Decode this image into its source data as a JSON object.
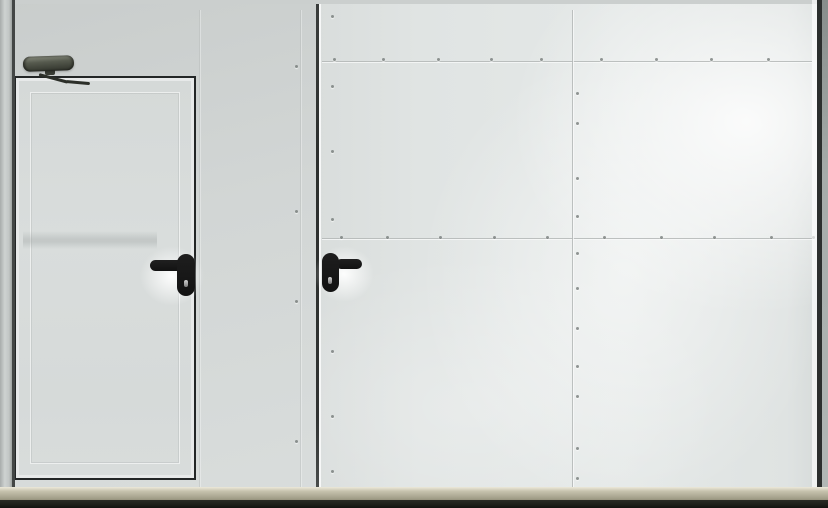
{
  "meta": {
    "kind": "photograph",
    "subject": "White industrial fire-rated gate wall with built-in wicket pedestrian door and large riveted gate leaf",
    "text_visible": "none"
  },
  "colors": {
    "panel_left": "#d2d6d5",
    "panel_left_dark": "#c9cdcc",
    "panel_right": "#e0e4e3",
    "panel_highlight": "#f5f8f7",
    "frame_line_dark": "#2c2f2e",
    "edge_metal_light": "#ced2d1",
    "edge_metal_dark": "#878d8b",
    "wicket_frame": "#232626",
    "door_leaf": "#d9dddc",
    "handle_black": "#121212",
    "closer_body_light": "#565a4e",
    "closer_body_dark": "#2f322a",
    "seam_line": "#b4b8b7",
    "rivet": "#707674",
    "sill_light": "#c7c3ae",
    "sill_dark": "#a3a08a",
    "floor_shadow": "#1d1e19"
  },
  "objects": {
    "left_wall": "white wall panel section",
    "wicket_door": "wicket pedestrian door with black perimeter frame",
    "door_closer": "overhead hydraulic door closer with articulated arm",
    "wicket_handle": "black lever handle on oval escutcheon with keyhole, lever pointing left",
    "gate_leaf": "large white gate leaf with riveted panel seams",
    "leaf_handle": "black lever handle on oval escutcheon with keyhole, lever pointing right",
    "bottom_sill": "beige metal threshold rail",
    "floor_shadow": "dark floor gap below doors"
  },
  "rivets": {
    "top_seam": {
      "y": 58,
      "xs": [
        333,
        382,
        437,
        490,
        540,
        600,
        655,
        710,
        767
      ]
    },
    "mid_seam": {
      "y": 236,
      "xs": [
        340,
        386,
        439,
        493,
        546,
        603,
        660,
        713,
        770,
        812
      ]
    },
    "vertical_seam": {
      "x": 576,
      "ys": [
        92,
        122,
        177,
        215,
        252,
        287,
        327,
        365,
        395,
        447,
        477
      ]
    },
    "left_column": {
      "x": 331,
      "ys": [
        15,
        85,
        150,
        218,
        350,
        415,
        470
      ]
    },
    "jamb_column": {
      "x": 295,
      "ys": [
        65,
        210,
        300,
        440
      ]
    }
  }
}
